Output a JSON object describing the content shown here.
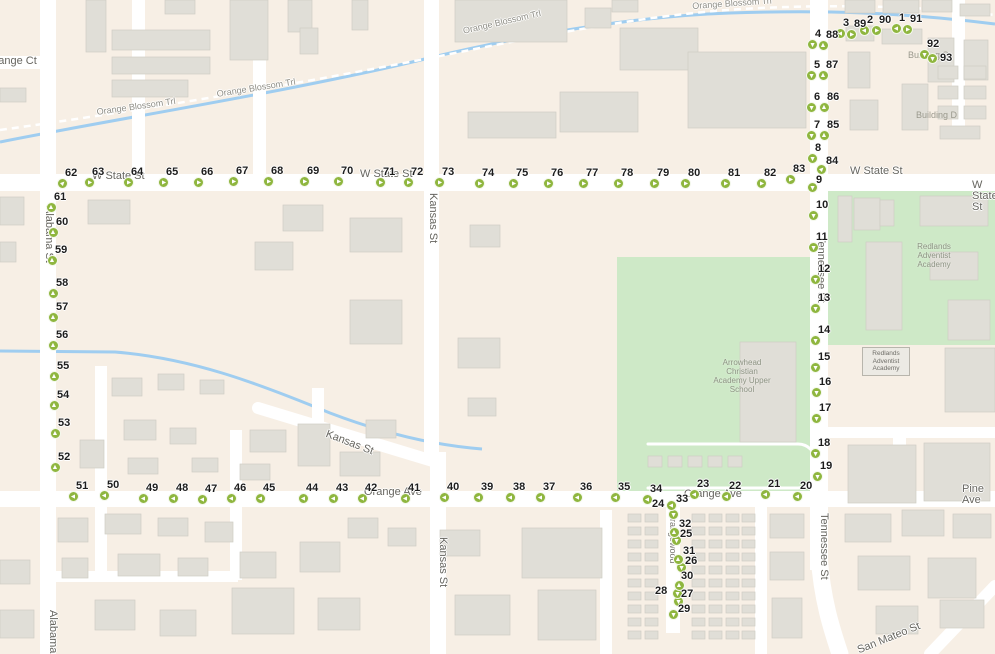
{
  "map": {
    "colors": {
      "land": "#f7efe5",
      "road": "#ffffff",
      "building_fill": "#e0ded7",
      "building_stroke": "#cfcdc5",
      "green_area": "#cee9c7",
      "creek": "#9fcdf0",
      "marker_green": "#8fb63f",
      "marker_number_text": "#1d1d1d",
      "street_label_text": "#66655f"
    },
    "street_labels": [
      {
        "t": "Orange Ct",
        "x": -14,
        "y": 56,
        "r": 0,
        "c": "st"
      },
      {
        "t": "Orange Blossom Trl",
        "x": 96,
        "y": 107,
        "r": -8,
        "c": "trail"
      },
      {
        "t": "Orange Blossom Trl",
        "x": 216,
        "y": 89,
        "r": -9,
        "c": "trail"
      },
      {
        "t": "Orange Blossom Trl",
        "x": 462,
        "y": 26,
        "r": -13,
        "c": "trail"
      },
      {
        "t": "Orange Blossom Trl",
        "x": 692,
        "y": 1,
        "r": -4,
        "c": "trail"
      },
      {
        "t": "W State St",
        "x": 92,
        "y": 171,
        "r": 0,
        "c": "st"
      },
      {
        "t": "W State St",
        "x": 360,
        "y": 169,
        "r": 0,
        "c": "st"
      },
      {
        "t": "W State St",
        "x": 850,
        "y": 166,
        "r": 0,
        "c": "st"
      },
      {
        "t": "W State St",
        "x": 972,
        "y": 180,
        "r": 0,
        "c": "st"
      },
      {
        "t": "Alabama St",
        "x": 54,
        "y": 206,
        "r": 90,
        "c": "st"
      },
      {
        "t": "Alabama St",
        "x": 58,
        "y": 610,
        "r": 90,
        "c": "st"
      },
      {
        "t": "Kansas St",
        "x": 438,
        "y": 193,
        "r": 90,
        "c": "st"
      },
      {
        "t": "Kansas St",
        "x": 328,
        "y": 429,
        "r": 21,
        "c": "st"
      },
      {
        "t": "Kansas St",
        "x": 448,
        "y": 537,
        "r": 90,
        "c": "st"
      },
      {
        "t": "Tennessee St",
        "x": 826,
        "y": 236,
        "r": 90,
        "c": "st"
      },
      {
        "t": "Tennessee St",
        "x": 829,
        "y": 513,
        "r": 90,
        "c": "st"
      },
      {
        "t": "Orange Ave",
        "x": 364,
        "y": 487,
        "r": 0,
        "c": "st"
      },
      {
        "t": "Orange Ave",
        "x": 684,
        "y": 489,
        "r": 0,
        "c": "st"
      },
      {
        "t": "Pine Ave",
        "x": 962,
        "y": 484,
        "r": 0,
        "c": "st"
      },
      {
        "t": "San Mateo St",
        "x": 856,
        "y": 646,
        "r": -22,
        "c": "st"
      },
      {
        "t": "Orangewood",
        "x": 678,
        "y": 512,
        "r": 90,
        "c": "st-small"
      },
      {
        "t": "Building S",
        "x": 908,
        "y": 50,
        "r": 0,
        "c": "poi"
      },
      {
        "t": "Building D",
        "x": 916,
        "y": 110,
        "r": 0,
        "c": "poi"
      },
      {
        "t": "Redlands\nAdventist\nAcademy",
        "x": 898,
        "y": 242,
        "r": 0,
        "c": "poi-multi"
      },
      {
        "t": "Arrowhead\nChristian\nAcademy Upper\nSchool",
        "x": 706,
        "y": 358,
        "r": 0,
        "c": "poi-multi"
      },
      {
        "t": "Redlands\nAdventist\nAcademy",
        "x": 862,
        "y": 347,
        "r": 0,
        "c": "boxed"
      }
    ],
    "markers": [
      {
        "n": 1,
        "x": 896,
        "y": 28,
        "d": "w"
      },
      {
        "n": 2,
        "x": 864,
        "y": 30,
        "d": "w"
      },
      {
        "n": 3,
        "x": 840,
        "y": 33,
        "d": "w"
      },
      {
        "n": 4,
        "x": 812,
        "y": 44,
        "d": "s"
      },
      {
        "n": 5,
        "x": 811,
        "y": 75,
        "d": "s"
      },
      {
        "n": 6,
        "x": 811,
        "y": 107,
        "d": "s"
      },
      {
        "n": 7,
        "x": 811,
        "y": 135,
        "d": "s"
      },
      {
        "n": 8,
        "x": 812,
        "y": 158,
        "d": "s"
      },
      {
        "n": 9,
        "x": 812,
        "y": 187,
        "d": "s",
        "lx": 816,
        "ly": 175
      },
      {
        "n": 10,
        "x": 813,
        "y": 215,
        "d": "s"
      },
      {
        "n": 11,
        "x": 813,
        "y": 247,
        "d": "s"
      },
      {
        "n": 12,
        "x": 815,
        "y": 279,
        "d": "s"
      },
      {
        "n": 13,
        "x": 815,
        "y": 308,
        "d": "s"
      },
      {
        "n": 14,
        "x": 815,
        "y": 340,
        "d": "s"
      },
      {
        "n": 15,
        "x": 815,
        "y": 367,
        "d": "s"
      },
      {
        "n": 16,
        "x": 816,
        "y": 392,
        "d": "s"
      },
      {
        "n": 17,
        "x": 816,
        "y": 418,
        "d": "s"
      },
      {
        "n": 18,
        "x": 815,
        "y": 453,
        "d": "s"
      },
      {
        "n": 19,
        "x": 817,
        "y": 476,
        "d": "s"
      },
      {
        "n": 20,
        "x": 797,
        "y": 496,
        "d": "w"
      },
      {
        "n": 21,
        "x": 765,
        "y": 494,
        "d": "w"
      },
      {
        "n": 22,
        "x": 726,
        "y": 496,
        "d": "w"
      },
      {
        "n": 23,
        "x": 694,
        "y": 494,
        "d": "w"
      },
      {
        "n": 24,
        "x": 673,
        "y": 514,
        "d": "s",
        "lx": 652,
        "ly": 499
      },
      {
        "n": 25,
        "x": 676,
        "y": 540,
        "d": "s",
        "lx": 680,
        "ly": 529
      },
      {
        "n": 26,
        "x": 681,
        "y": 567,
        "d": "s",
        "lx": 685,
        "ly": 556
      },
      {
        "n": 27,
        "x": 678,
        "y": 601,
        "d": "s",
        "lx": 681,
        "ly": 589
      },
      {
        "n": 28,
        "x": 677,
        "y": 593,
        "d": "s",
        "lx": 655,
        "ly": 586
      },
      {
        "n": 29,
        "x": 673,
        "y": 614,
        "d": "s",
        "lx": 678,
        "ly": 604
      },
      {
        "n": 30,
        "x": 679,
        "y": 585,
        "d": "n",
        "lx": 681,
        "ly": 571
      },
      {
        "n": 31,
        "x": 678,
        "y": 559,
        "d": "n",
        "lx": 683,
        "ly": 546
      },
      {
        "n": 32,
        "x": 674,
        "y": 532,
        "d": "n",
        "lx": 679,
        "ly": 519
      },
      {
        "n": 33,
        "x": 671,
        "y": 505,
        "d": "w",
        "lx": 676,
        "ly": 494
      },
      {
        "n": 34,
        "x": 647,
        "y": 499,
        "d": "w"
      },
      {
        "n": 35,
        "x": 615,
        "y": 497,
        "d": "w"
      },
      {
        "n": 36,
        "x": 577,
        "y": 497,
        "d": "w"
      },
      {
        "n": 37,
        "x": 540,
        "y": 497,
        "d": "w"
      },
      {
        "n": 38,
        "x": 510,
        "y": 497,
        "d": "w"
      },
      {
        "n": 39,
        "x": 478,
        "y": 497,
        "d": "w"
      },
      {
        "n": 40,
        "x": 444,
        "y": 497,
        "d": "w"
      },
      {
        "n": 41,
        "x": 405,
        "y": 498,
        "d": "w"
      },
      {
        "n": 42,
        "x": 362,
        "y": 498,
        "d": "w"
      },
      {
        "n": 43,
        "x": 333,
        "y": 498,
        "d": "w"
      },
      {
        "n": 44,
        "x": 303,
        "y": 498,
        "d": "w"
      },
      {
        "n": 45,
        "x": 260,
        "y": 498,
        "d": "w"
      },
      {
        "n": 46,
        "x": 231,
        "y": 498,
        "d": "w"
      },
      {
        "n": 47,
        "x": 202,
        "y": 499,
        "d": "w"
      },
      {
        "n": 48,
        "x": 173,
        "y": 498,
        "d": "w"
      },
      {
        "n": 49,
        "x": 143,
        "y": 498,
        "d": "w"
      },
      {
        "n": 50,
        "x": 104,
        "y": 495,
        "d": "w"
      },
      {
        "n": 51,
        "x": 73,
        "y": 496,
        "d": "w"
      },
      {
        "n": 52,
        "x": 55,
        "y": 467,
        "d": "n"
      },
      {
        "n": 53,
        "x": 55,
        "y": 433,
        "d": "n"
      },
      {
        "n": 54,
        "x": 54,
        "y": 405,
        "d": "n"
      },
      {
        "n": 55,
        "x": 54,
        "y": 376,
        "d": "n"
      },
      {
        "n": 56,
        "x": 53,
        "y": 345,
        "d": "n"
      },
      {
        "n": 57,
        "x": 53,
        "y": 317,
        "d": "n"
      },
      {
        "n": 58,
        "x": 53,
        "y": 293,
        "d": "n"
      },
      {
        "n": 59,
        "x": 52,
        "y": 260,
        "d": "n"
      },
      {
        "n": 60,
        "x": 53,
        "y": 232,
        "d": "n"
      },
      {
        "n": 61,
        "x": 51,
        "y": 207,
        "d": "n"
      },
      {
        "n": 62,
        "x": 62,
        "y": 183,
        "d": "ne"
      },
      {
        "n": 63,
        "x": 89,
        "y": 182,
        "d": "e"
      },
      {
        "n": 64,
        "x": 128,
        "y": 182,
        "d": "e"
      },
      {
        "n": 65,
        "x": 163,
        "y": 182,
        "d": "e"
      },
      {
        "n": 66,
        "x": 198,
        "y": 182,
        "d": "e"
      },
      {
        "n": 67,
        "x": 233,
        "y": 181,
        "d": "e"
      },
      {
        "n": 68,
        "x": 268,
        "y": 181,
        "d": "e"
      },
      {
        "n": 69,
        "x": 304,
        "y": 181,
        "d": "e"
      },
      {
        "n": 70,
        "x": 338,
        "y": 181,
        "d": "e"
      },
      {
        "n": 71,
        "x": 380,
        "y": 182,
        "d": "e"
      },
      {
        "n": 72,
        "x": 408,
        "y": 182,
        "d": "e"
      },
      {
        "n": 73,
        "x": 439,
        "y": 182,
        "d": "e"
      },
      {
        "n": 74,
        "x": 479,
        "y": 183,
        "d": "e"
      },
      {
        "n": 75,
        "x": 513,
        "y": 183,
        "d": "e"
      },
      {
        "n": 76,
        "x": 548,
        "y": 183,
        "d": "e"
      },
      {
        "n": 77,
        "x": 583,
        "y": 183,
        "d": "e"
      },
      {
        "n": 78,
        "x": 618,
        "y": 183,
        "d": "e"
      },
      {
        "n": 79,
        "x": 654,
        "y": 183,
        "d": "e"
      },
      {
        "n": 80,
        "x": 685,
        "y": 183,
        "d": "e"
      },
      {
        "n": 81,
        "x": 725,
        "y": 183,
        "d": "e"
      },
      {
        "n": 82,
        "x": 761,
        "y": 183,
        "d": "e"
      },
      {
        "n": 83,
        "x": 790,
        "y": 179,
        "d": "e"
      },
      {
        "n": 84,
        "x": 821,
        "y": 169,
        "d": "ne",
        "lx": 826,
        "ly": 156
      },
      {
        "n": 85,
        "x": 824,
        "y": 135,
        "d": "n"
      },
      {
        "n": 86,
        "x": 824,
        "y": 107,
        "d": "n"
      },
      {
        "n": 87,
        "x": 823,
        "y": 75,
        "d": "n"
      },
      {
        "n": 88,
        "x": 823,
        "y": 45,
        "d": "n"
      },
      {
        "n": 89,
        "x": 851,
        "y": 34,
        "d": "e"
      },
      {
        "n": 90,
        "x": 876,
        "y": 30,
        "d": "e"
      },
      {
        "n": 91,
        "x": 907,
        "y": 29,
        "d": "e"
      },
      {
        "n": 92,
        "x": 924,
        "y": 54,
        "d": "s"
      },
      {
        "n": 93,
        "x": 932,
        "y": 58,
        "d": "s",
        "lx": 940,
        "ly": 53
      }
    ]
  }
}
